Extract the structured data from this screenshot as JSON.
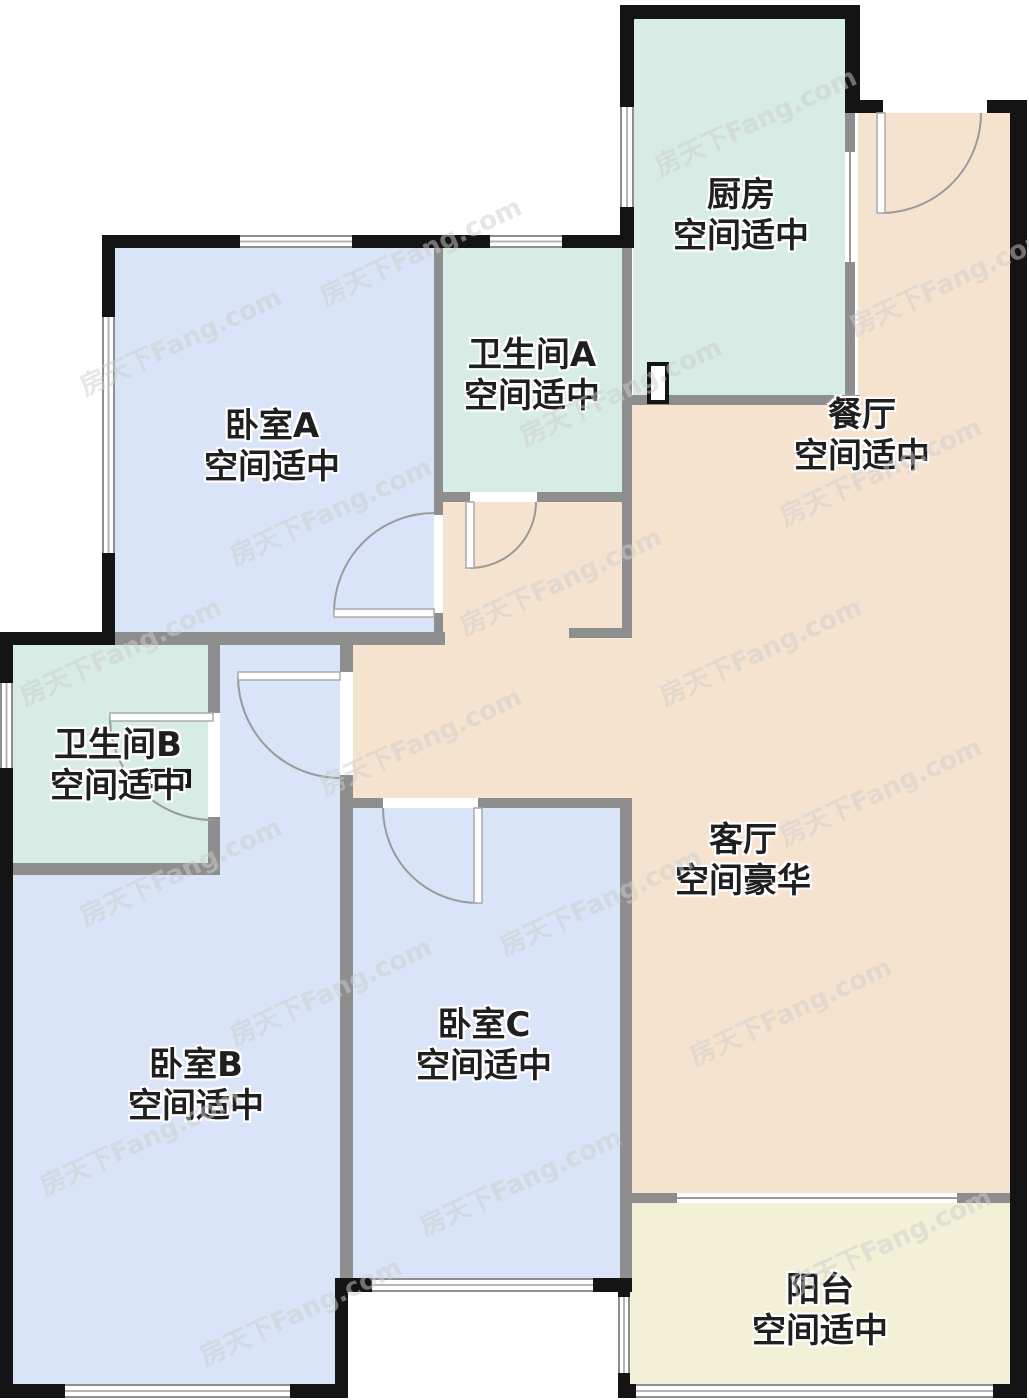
{
  "plan": {
    "watermark": "房天下Fang.com",
    "colors": {
      "bedroom_fill": "#d9e4f8",
      "bath_kitchen_fill": "#d6ece4",
      "living_fill": "#f6e3cf",
      "balcony_fill": "#f2f0d7",
      "exterior_wall": "#141414",
      "interior_wall": "#8e8e8e",
      "door_arc": "#9a9a9a",
      "label_text": "#1f1f1f"
    }
  },
  "rooms": {
    "kitchen": {
      "name": "厨房",
      "size": "空间适中"
    },
    "dining": {
      "name": "餐厅",
      "size": "空间适中"
    },
    "bathroom_a": {
      "name": "卫生间A",
      "size": "空间适中"
    },
    "bedroom_a": {
      "name": "卧室A",
      "size": "空间适中"
    },
    "bathroom_b": {
      "name": "卫生间B",
      "size": "空间适中"
    },
    "living_room": {
      "name": "客厅",
      "size": "空间豪华"
    },
    "bedroom_c": {
      "name": "卧室C",
      "size": "空间适中"
    },
    "bedroom_b": {
      "name": "卧室B",
      "size": "空间适中"
    },
    "balcony": {
      "name": "阳台",
      "size": "空间适中"
    }
  }
}
